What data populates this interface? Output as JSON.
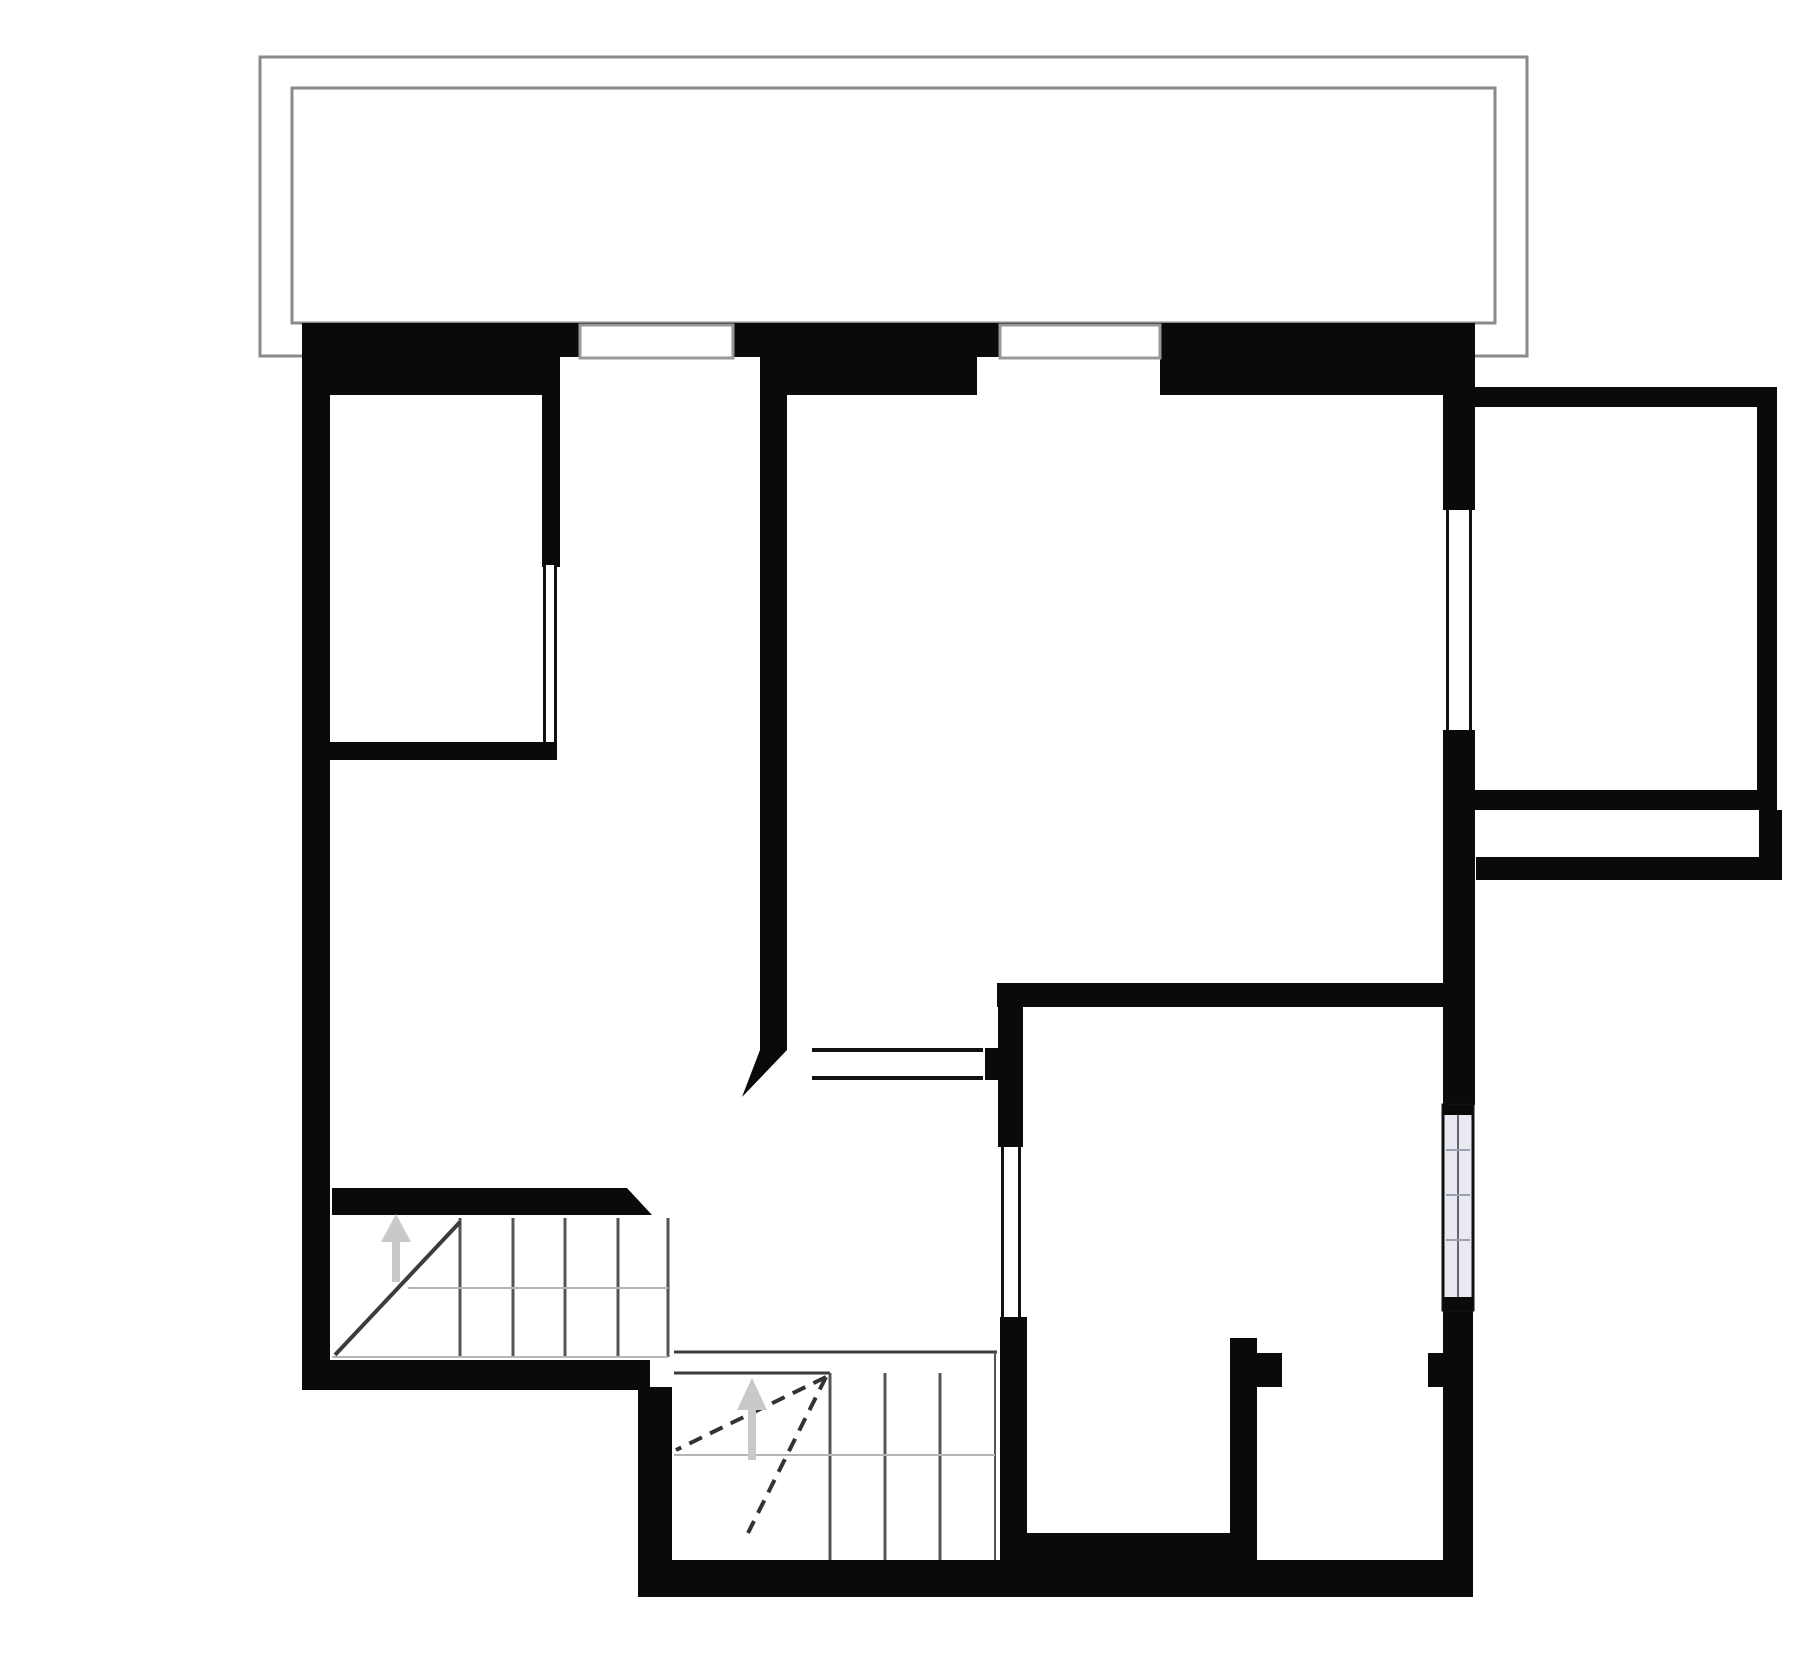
{
  "canvas": {
    "w": 1800,
    "h": 1656,
    "bg": "#ffffff"
  },
  "colors": {
    "wall": "#0a0a0a",
    "balcony_line": "#8a8a8a",
    "frame_line": "#989898",
    "glass_line": "#111111",
    "stair_line": "#3c3c3c",
    "tread_line": "#555555",
    "light_line": "#b5b5b5",
    "dash_line": "#333333",
    "arrow": "#c9c9c9",
    "striped_fill": "#e9e9f2",
    "striped_line": "#9aa0b0",
    "white": "#ffffff"
  },
  "balcony": {
    "rects": [
      {
        "name": "balcony-outer-outline",
        "x": 260,
        "y": 57,
        "w": 1267,
        "h": 299
      },
      {
        "name": "balcony-inner-outline",
        "x": 292,
        "y": 88,
        "w": 1203,
        "h": 235
      }
    ]
  },
  "walls": [
    {
      "name": "top-wall",
      "x": 302,
      "y": 323,
      "w": 1143,
      "h": 72
    },
    {
      "name": "left-wall",
      "x": 302,
      "y": 323,
      "w": 28,
      "h": 1067
    },
    {
      "name": "right-wall-upper",
      "x": 1443,
      "y": 323,
      "w": 32,
      "h": 187
    },
    {
      "name": "right-wall-mid",
      "x": 1443,
      "y": 730,
      "w": 32,
      "h": 375
    },
    {
      "name": "right-wall-lower",
      "x": 1443,
      "y": 1310,
      "w": 30,
      "h": 250
    },
    {
      "name": "extension-top-wall",
      "x": 1475,
      "y": 387,
      "w": 302,
      "h": 20
    },
    {
      "name": "extension-right-wall",
      "x": 1757,
      "y": 387,
      "w": 20,
      "h": 423
    },
    {
      "name": "extension-bottom-wall",
      "x": 1475,
      "y": 790,
      "w": 302,
      "h": 20
    },
    {
      "name": "southeast-wall",
      "x": 1476,
      "y": 857,
      "w": 283,
      "h": 23
    },
    {
      "name": "southeast-wall-stub",
      "x": 1759,
      "y": 810,
      "w": 23,
      "h": 70
    },
    {
      "name": "room1-side-wall",
      "x": 542,
      "y": 357,
      "w": 18,
      "h": 210
    },
    {
      "name": "room1-bottom-wall",
      "x": 330,
      "y": 742,
      "w": 227,
      "h": 18
    },
    {
      "name": "hall-partition-wall",
      "x": 760,
      "y": 357,
      "w": 27,
      "h": 693
    },
    {
      "name": "interior-wall-horizontal",
      "x": 997,
      "y": 983,
      "w": 447,
      "h": 24
    },
    {
      "name": "interior-wall-vertical",
      "x": 998,
      "y": 983,
      "w": 25,
      "h": 164
    },
    {
      "name": "doorway-stub",
      "x": 985,
      "y": 1048,
      "w": 13,
      "h": 32
    },
    {
      "name": "room-divider-wall",
      "x": 1000,
      "y": 1317,
      "w": 27,
      "h": 280
    },
    {
      "name": "bath-partition-wall",
      "x": 1230,
      "y": 1338,
      "w": 27,
      "h": 222
    },
    {
      "name": "bath-door-nub",
      "x": 1257,
      "y": 1353,
      "w": 25,
      "h": 34
    },
    {
      "name": "right-door-nub",
      "x": 1428,
      "y": 1353,
      "w": 15,
      "h": 34
    },
    {
      "name": "stairs-top-wall",
      "x": 332,
      "y": 1188,
      "w": 295,
      "h": 27
    },
    {
      "name": "bottom-wall-left",
      "x": 303,
      "y": 1360,
      "w": 347,
      "h": 30
    },
    {
      "name": "stair-bay-left-wall",
      "x": 638,
      "y": 1387,
      "w": 34,
      "h": 210
    },
    {
      "name": "bottom-wall-main",
      "x": 638,
      "y": 1560,
      "w": 835,
      "h": 37
    },
    {
      "name": "bottom-step-wall",
      "x": 1025,
      "y": 1533,
      "w": 205,
      "h": 30
    }
  ],
  "polygons": [
    {
      "name": "hall-wall-chamfer",
      "points": "760,1050 787,1050 742,1097"
    },
    {
      "name": "stairs-wall-chamfer",
      "points": "627,1188 652,1215 627,1215"
    }
  ],
  "window_recesses": [
    {
      "name": "window-recess-1",
      "x": 560,
      "y": 357,
      "w": 200,
      "h": 38
    },
    {
      "name": "window-recess-2",
      "x": 977,
      "y": 357,
      "w": 183,
      "h": 38
    }
  ],
  "window_frames": [
    {
      "name": "top-window-1",
      "x": 580,
      "y": 325,
      "w": 153,
      "h": 33
    },
    {
      "name": "top-window-2",
      "x": 1000,
      "y": 325,
      "w": 160,
      "h": 33
    }
  ],
  "glass_windows": [
    {
      "name": "east-window",
      "x": 1446,
      "y": 510,
      "w": 26,
      "h": 220
    },
    {
      "name": "room1-glass-door",
      "x": 543,
      "y": 565,
      "w": 14,
      "h": 177
    },
    {
      "name": "hall-window",
      "x": 1001,
      "y": 1147,
      "w": 20,
      "h": 170
    }
  ],
  "striped_window": {
    "name": "south-window",
    "x": 1443,
    "y": 1105,
    "w": 30,
    "h": 205,
    "cap_top_h": 10,
    "cap_bottom_h": 13,
    "ticks_y": [
      1150,
      1195,
      1240
    ]
  },
  "opening_lines": [
    {
      "name": "opening-sill-top",
      "x1": 812,
      "y1": 1050,
      "x2": 983,
      "y2": 1050
    },
    {
      "name": "opening-sill-bottom",
      "x1": 812,
      "y1": 1078,
      "x2": 983,
      "y2": 1078
    }
  ],
  "stairs_upper": {
    "treads_x": [
      460,
      513,
      565,
      618
    ],
    "tread_y1": 1218,
    "tread_y2": 1357,
    "boundary": {
      "x": 668,
      "y1": 1218,
      "y2": 1357
    },
    "stringer": {
      "x1": 408,
      "y1": 1288,
      "x2": 668,
      "y2": 1288
    },
    "bottom_line": {
      "x1": 332,
      "y1": 1357,
      "x2": 668,
      "y2": 1357
    },
    "diagonal": {
      "x1": 335,
      "y1": 1355,
      "x2": 460,
      "y2": 1222
    }
  },
  "stairs_lower": {
    "top_line_1": {
      "x1": 674,
      "y1": 1352,
      "x2": 997,
      "y2": 1352
    },
    "top_line_2": {
      "x1": 674,
      "y1": 1373,
      "x2": 830,
      "y2": 1373
    },
    "treads_x": [
      830,
      885,
      940
    ],
    "tread_y1": 1373,
    "tread_y2": 1560,
    "boundary": {
      "x": 995,
      "y1": 1352,
      "y2": 1560
    },
    "stringer": {
      "x1": 674,
      "y1": 1455,
      "x2": 995,
      "y2": 1455
    },
    "dashed": [
      {
        "name": "walkline-1",
        "x1": 826,
        "y1": 1377,
        "x2": 676,
        "y2": 1450
      },
      {
        "name": "walkline-2",
        "x1": 826,
        "y1": 1377,
        "x2": 748,
        "y2": 1533
      }
    ]
  },
  "arrows": [
    {
      "name": "stairs-up-arrow-1",
      "x": 396,
      "tail_y": 1282,
      "shaft_top_y": 1240,
      "head_tip_y": 1214,
      "head_half_w": 15
    },
    {
      "name": "stairs-up-arrow-2",
      "x": 752,
      "tail_y": 1460,
      "shaft_top_y": 1408,
      "head_tip_y": 1378,
      "head_half_w": 15
    }
  ]
}
